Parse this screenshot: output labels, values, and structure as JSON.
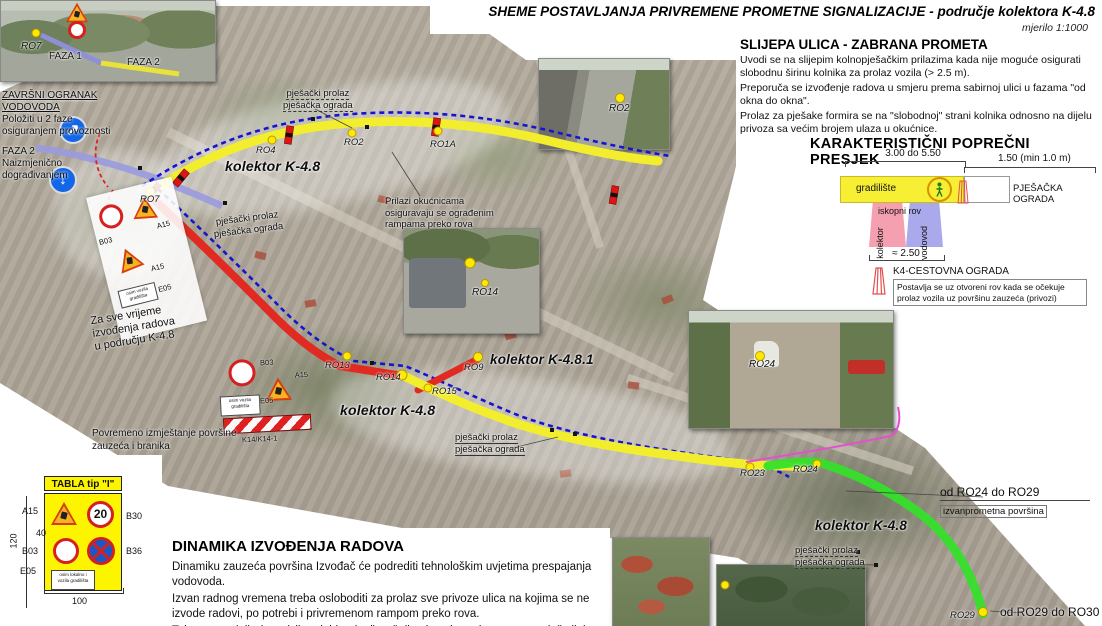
{
  "header": {
    "title": "SHEME POSTAVLJANJA PRIVREMENE PROMETNE SIGNALIZACIJE - područje kolektora K-4.8",
    "scale": "mjerilo 1:1000"
  },
  "right_panel": {
    "slijepa": {
      "heading": "SLIJEPA ULICA - ZABRANA PROMETA",
      "p1": "Uvodi se na slijepim kolnopješačkim prilazima kada nije moguće osigurati slobodnu širinu kolnika za prolaz vozila (> 2.5 m).",
      "p2": "Preporuča se izvođenje radova u smjeru prema sabirnoj ulici u fazama \"od okna do okna\".",
      "p3": "Prolaz za pješake formira se na \"slobodnoj\" strani kolnika odnosno na dijelu privoza sa većim brojem ulaza u okućnice."
    },
    "presjek": {
      "heading": "KARAKTERISTIČNI POPREČNI PRESJEK",
      "dim_top": "3.00 do 5.50",
      "dim_right": "1.50 (min 1.0 m)",
      "gradiliste": "gradilište",
      "pjesacka_ograda": "PJEŠAČKA OGRADA",
      "iskopni_rov": "iskopni rov",
      "kolektor": "kolektor",
      "vodovod": "vodovod",
      "dim_bottom": "≈ 2.50"
    },
    "k4": {
      "title": "K4-CESTOVNA OGRADA",
      "l1": "Postavlja se uz otvoreni rov kada se očekuje",
      "l2": "prolaz vozila uz površinu zauzeća (privozi)"
    }
  },
  "map": {
    "collectors": {
      "k48": "kolektor K-4.8",
      "k481": "kolektor K-4.8.1"
    },
    "markers": {
      "ro1a": "RO1A",
      "ro2": "RO2",
      "ro4": "RO4",
      "ro7": "RO7",
      "ro9": "RO9",
      "ro13": "RO13",
      "ro14": "RO14",
      "ro15": "RO15",
      "ro23": "RO23",
      "ro24": "RO24",
      "ro29": "RO29"
    },
    "notes": {
      "zavrsni": [
        "ZAVRŠNI OGRANAK VODOVODA",
        "Položiti u 2 faze",
        "osiguranjem provoznosti"
      ],
      "faza2": [
        "FAZA 2",
        "Naizmjenično dograđivanjem"
      ],
      "pjesacki_prolaz": "pješački prolaz",
      "pjesacka_ograda": "pješačka ograda",
      "prilazi": [
        "Prilazi okućnicama",
        "osiguravaju se ograđenim",
        "rampama preko rova"
      ],
      "za_sve": [
        "Za sve vrijeme",
        "izvođenja radova",
        "u području K-4.8"
      ],
      "povremeno": [
        "Povremeno izmještanje površine",
        "zauzeća i branika"
      ],
      "od_ro24": [
        "od RO24 do RO29",
        "izvanprometna površina"
      ],
      "od_ro29": "od RO29 do RO30"
    },
    "signs": {
      "a15": "A15",
      "b03": "B03",
      "e05": "E05",
      "k14": "K14/K14-1",
      "e05_l1": "osim vozila",
      "e05_l2": "gradilišta"
    }
  },
  "photos": {
    "topleft": {
      "ro7": "RO7",
      "faza1": "FAZA 1",
      "faza2": "FAZA 2"
    },
    "ro2": "RO2",
    "ro14": "RO14",
    "ro24": "RO24"
  },
  "tabla": {
    "title": "TABLA tip \"I\"",
    "a15": "A15",
    "b30": "B30",
    "b03": "B03",
    "b36": "B36",
    "e05": "E05",
    "speed": "20",
    "e05_l1": "osim lokalno i",
    "e05_l2": "vozila gradilišta",
    "dim_h": "120",
    "dim_w": "100",
    "dim_40": "40"
  },
  "dinamika": {
    "heading": "DINAMIKA IZVOĐENJA RADOVA",
    "l1": "Dinamiku zauzeća površina Izvođač će podrediti tehnološkim uvjetima prespajanja vodovoda.",
    "l2": "Izvan radnog vremena treba osloboditi za prolaz sve privoze ulica na kojima se ne izvode radovi, po potrebi i privremenom rampom preko rova.",
    "l3": "Tokom neradnih dana (vikend, blagdani) poželjno je osigurati provoznost duž cijele ulice."
  },
  "colors": {
    "route_yellow": "#f2ee2e",
    "route_red": "#e02a22",
    "route_green": "#35e02a",
    "route_blue": "#1515cf",
    "vodovod_purple": "#9a9ade",
    "magenta": "#e44fd0",
    "board_yellow": "#fdf400",
    "sign_blue": "#1466e8",
    "sign_red": "#d42020"
  }
}
